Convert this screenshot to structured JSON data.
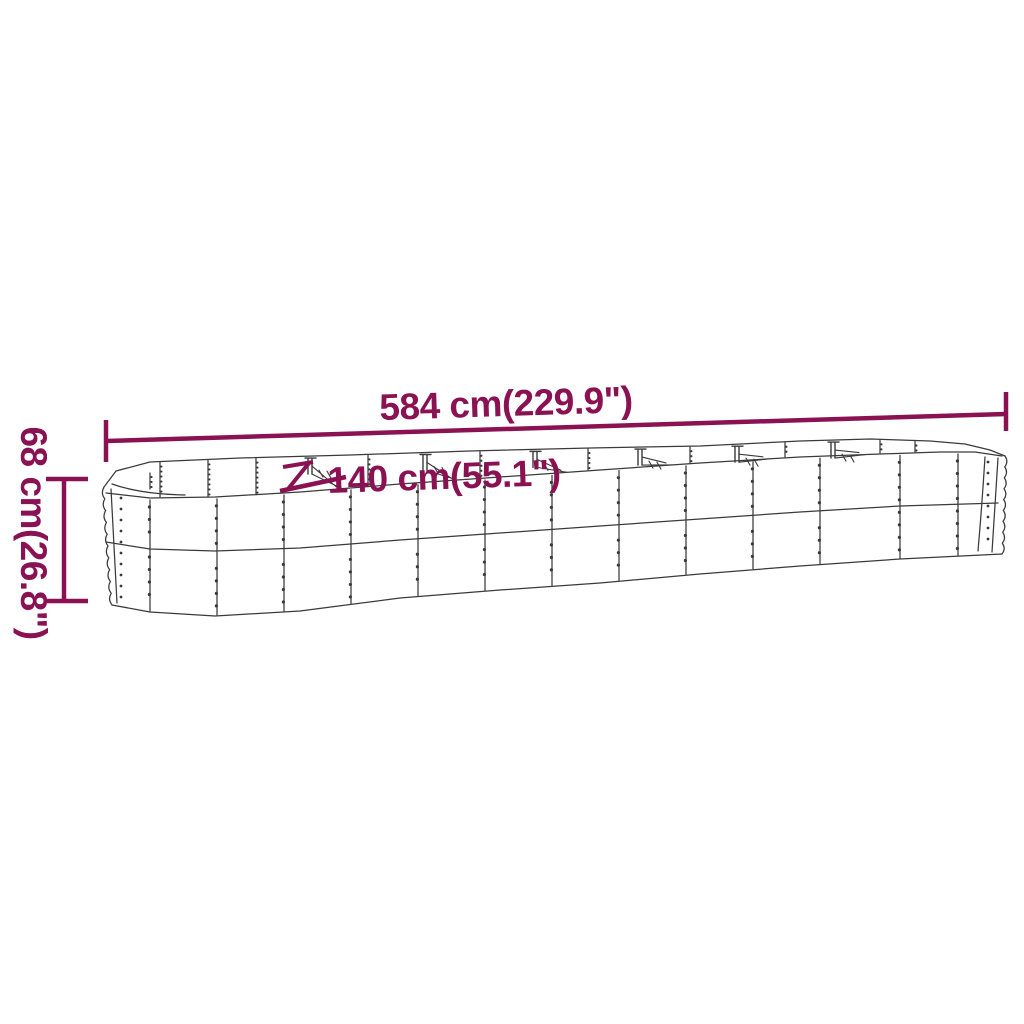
{
  "colors": {
    "dimension_accent": "#8A1253",
    "drawing_line": "#3A3A3A",
    "background": "#FFFFFF"
  },
  "dimensions": {
    "length": "584 cm(229.9\")",
    "width": "140 cm(55.1\")",
    "height": "68 cm(26.8\")"
  }
}
